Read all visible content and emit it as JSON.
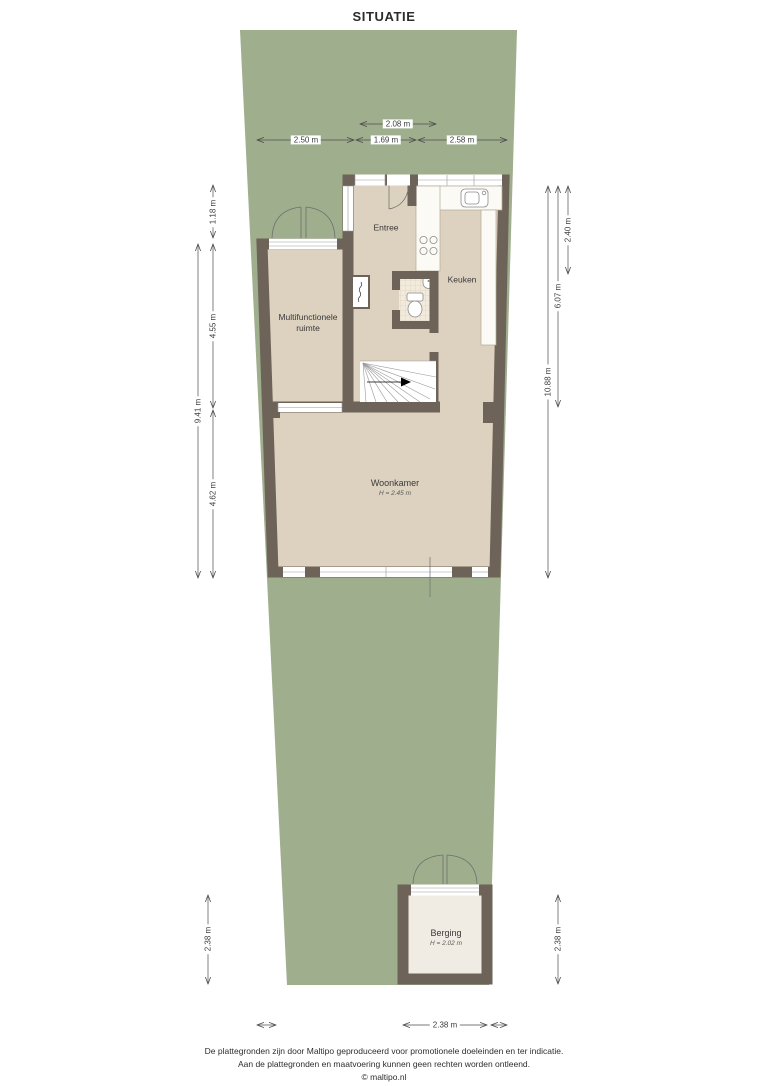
{
  "title": "SITUATIE",
  "plan": {
    "rooms": {
      "entree": {
        "label": "Entree"
      },
      "keuken": {
        "label": "Keuken"
      },
      "multifunctionele_ruimte": {
        "line1": "Multifunctionele",
        "line2": "ruimte"
      },
      "woonkamer": {
        "label": "Woonkamer",
        "height": "H = 2.45 m"
      },
      "berging": {
        "label": "Berging",
        "height": "H = 2.02 m"
      }
    },
    "fixtures": [
      "kitchen-counter",
      "sink",
      "stove",
      "toilet",
      "wash-basin",
      "boiler-closet",
      "stairs",
      "garden-double-doors",
      "berging-double-doors",
      "windows"
    ]
  },
  "dimensions": {
    "top_inner": "2.08 m",
    "top_chain": [
      "2.50 m",
      "1.69 m",
      "2.58 m"
    ],
    "left": {
      "segment_top": "1.18 m",
      "segment_upper": "4.55 m",
      "total": "9.41 m",
      "segment_lower": "4.62 m"
    },
    "right": {
      "segment_top": "2.40 m",
      "segment_mid": "6.07 m",
      "total": "10.88 m"
    },
    "berging": {
      "left_vertical": "2.38 m",
      "right_vertical": "2.38 m",
      "bottom_horizontal": "2.38 m"
    }
  },
  "colors": {
    "plot_green": "#9fae8d",
    "floor_beige": "#ddd1bf",
    "wall": "#6e6358",
    "berging_floor": "#f1ece3",
    "dimension_line": "#4d4d4d"
  },
  "footer": {
    "line1": "De plattegronden zijn door Maltipo geproduceerd voor promotionele doeleinden en ter indicatie.",
    "line2": "Aan de plattegronden en maatvoering kunnen geen rechten worden ontleend.",
    "line3": "© maltipo.nl"
  }
}
